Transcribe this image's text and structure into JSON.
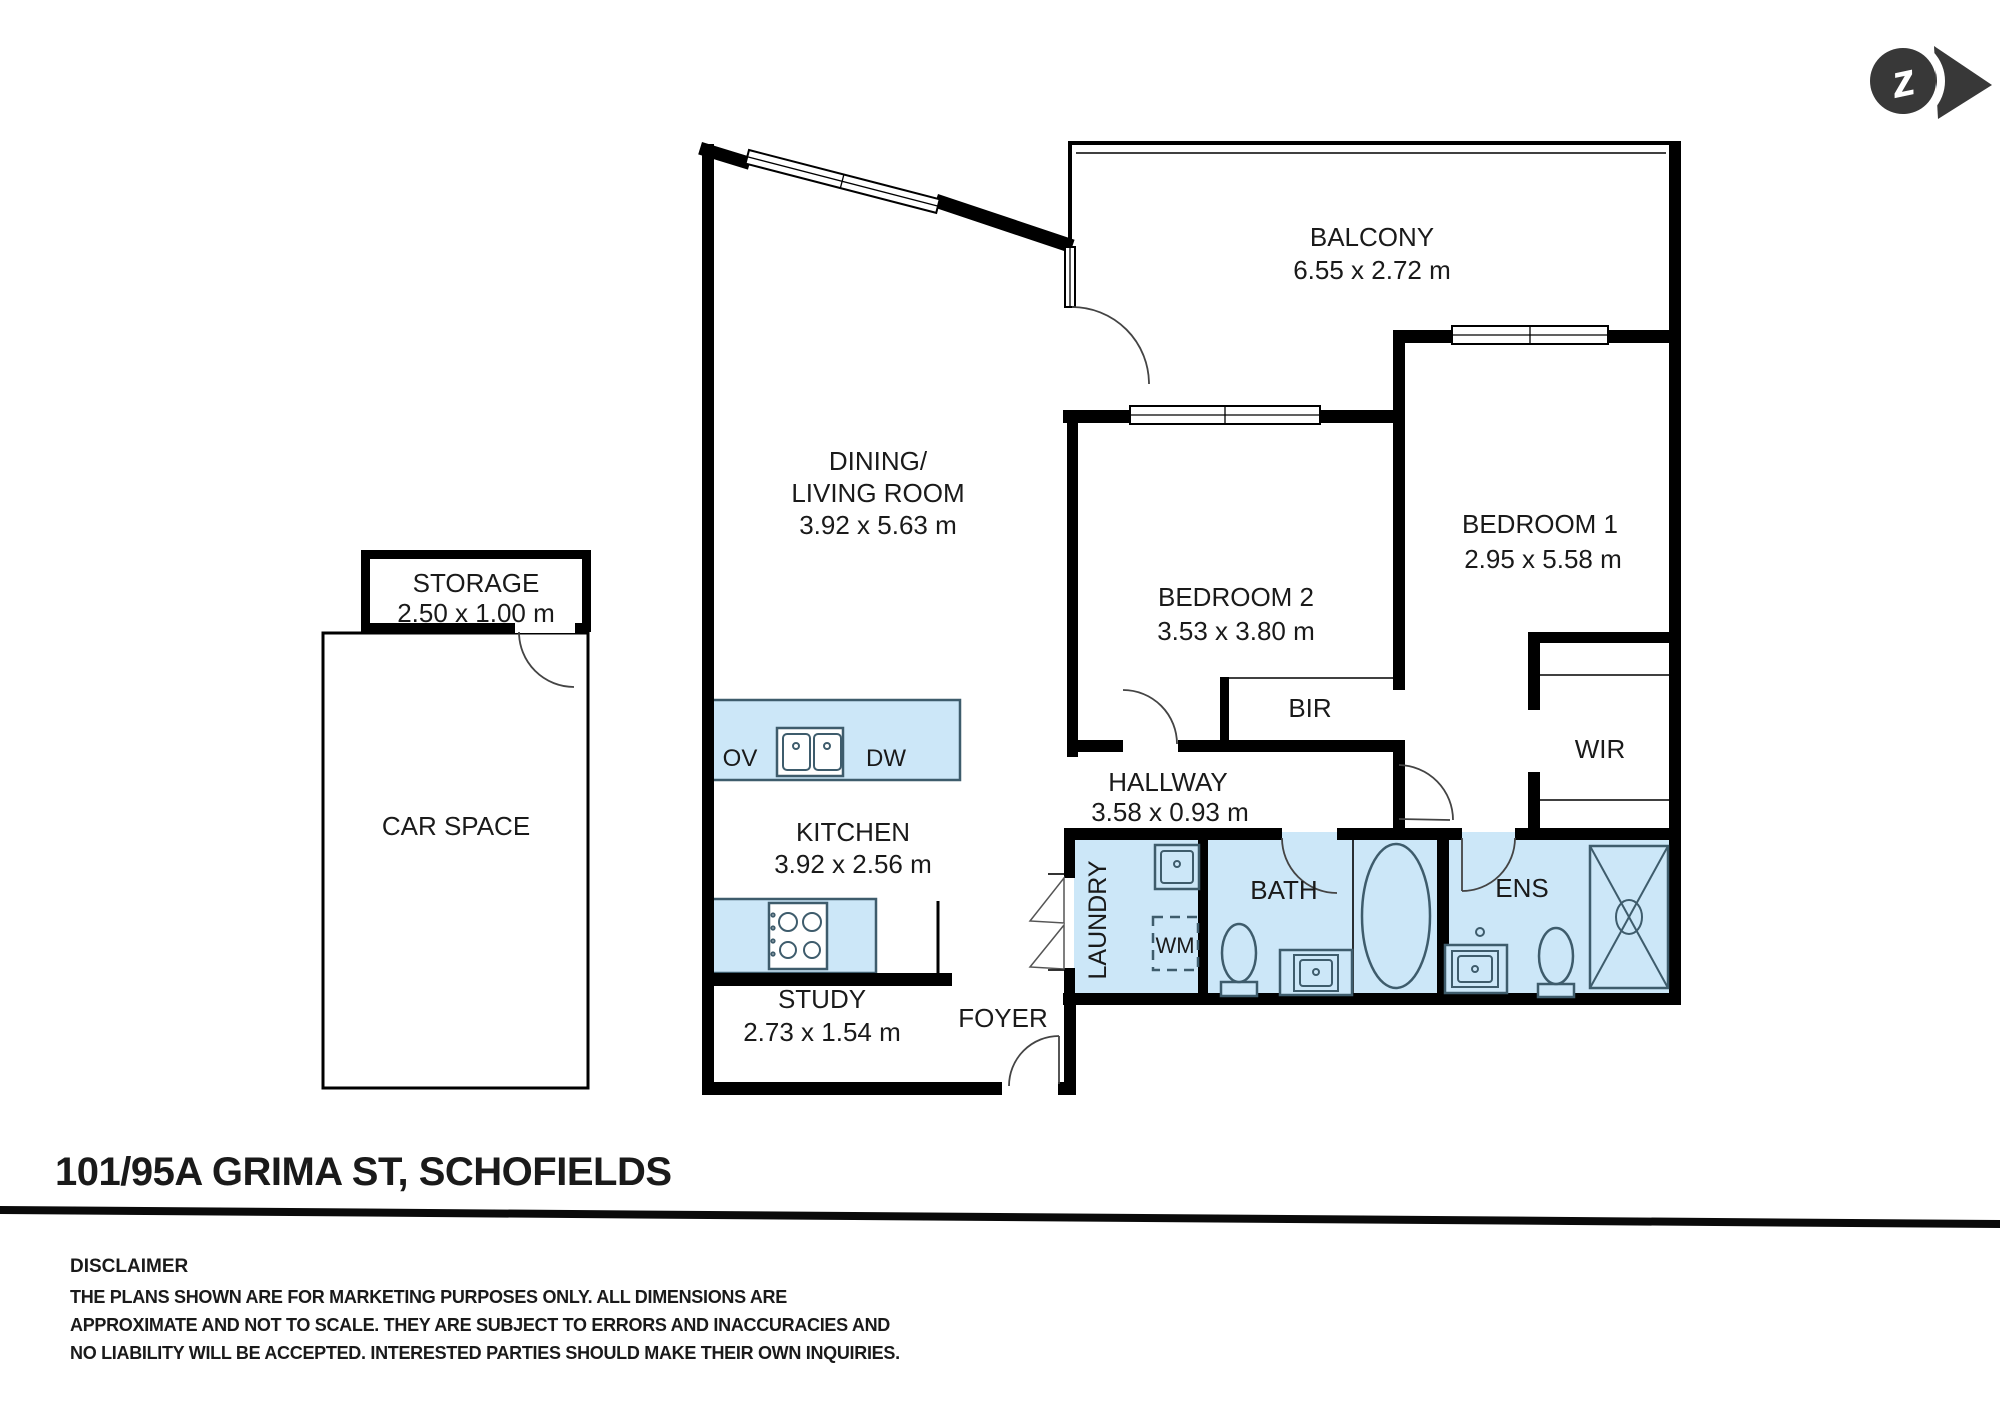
{
  "address": "101/95A GRIMA ST, SCHOFIELDS",
  "plan": {
    "rooms": {
      "dining": {
        "label1": "DINING/",
        "label2": "LIVING ROOM",
        "dims": "3.92 x 5.63 m"
      },
      "balcony": {
        "label": "BALCONY",
        "dims": "6.55 x 2.72 m"
      },
      "bedroom2": {
        "label": "BEDROOM 2",
        "dims": "3.53 x 3.80 m"
      },
      "bedroom1": {
        "label": "BEDROOM 1",
        "dims": "2.95 x 5.58 m"
      },
      "kitchen": {
        "label": "KITCHEN",
        "dims": "3.92 x 2.56 m"
      },
      "hallway": {
        "label": "HALLWAY",
        "dims": "3.58 x 0.93 m"
      },
      "study": {
        "label": "STUDY",
        "dims": "2.73 x 1.54 m"
      },
      "storage": {
        "label": "STORAGE",
        "dims": "2.50 x 1.00 m"
      },
      "carspace": {
        "label": "CAR SPACE"
      },
      "foyer": {
        "label": "FOYER"
      },
      "laundry": {
        "label": "LAUNDRY"
      },
      "bath": {
        "label": "BATH"
      },
      "ens": {
        "label": "ENS"
      },
      "wir": {
        "label": "WIR"
      },
      "bir": {
        "label": "BIR"
      }
    },
    "fixtures": {
      "oven": "OV",
      "dishwasher": "DW",
      "washing_machine": "WM"
    }
  },
  "logo": {
    "letter": "z"
  },
  "disclaimer": {
    "heading": "DISCLAIMER",
    "line1": "THE PLANS SHOWN ARE FOR MARKETING PURPOSES ONLY. ALL DIMENSIONS ARE",
    "line2": "APPROXIMATE AND NOT TO SCALE. THEY ARE SUBJECT TO ERRORS AND INACCURACIES AND",
    "line3": "NO LIABILITY WILL BE ACCEPTED. INTERESTED PARTIES SHOULD MAKE THEIR OWN INQUIRIES."
  },
  "colors": {
    "wall": "#000000",
    "wet_fill": "#cce7f8",
    "fixture_stroke": "#3e5c6c",
    "text": "#1a1a1a",
    "logo": "#383838"
  }
}
